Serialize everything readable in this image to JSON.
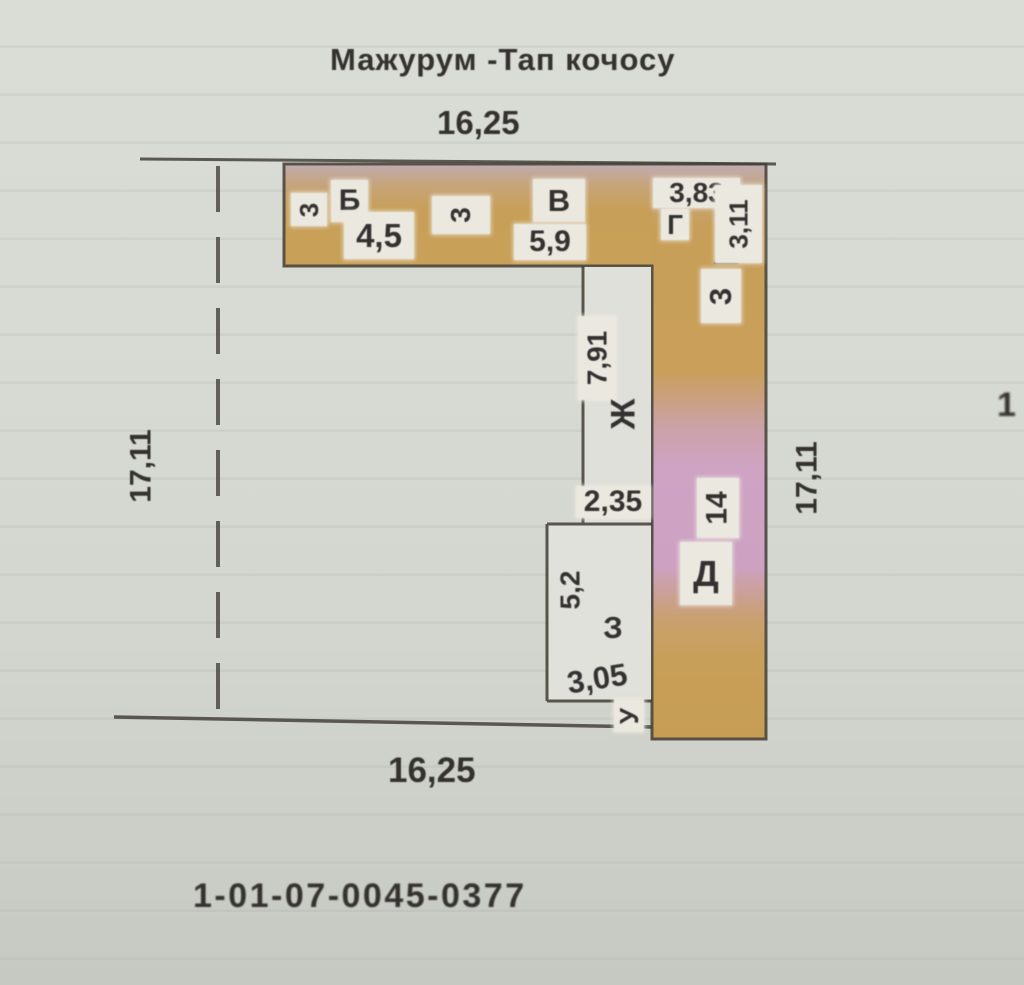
{
  "page": {
    "title": "Мажурум -Тап кочосу",
    "cadastral_number": "1-01-07-0045-0377",
    "edge_artifact": "1"
  },
  "boundary_dimensions": {
    "top": "16,25",
    "bottom": "16,25",
    "left": "17,11",
    "right": "17,11"
  },
  "colors": {
    "paper": "#d7d9d3",
    "band_orange": "#c89f58",
    "band_pink": "#cfa3c4",
    "band_pink_top": "#c0acb1",
    "outline": "#4a463e",
    "ink": "#34322e",
    "label_box": "#ebe8e0"
  },
  "plan": {
    "room_letters": [
      "Б",
      "В",
      "Г",
      "Д",
      "Ж",
      "З",
      "У"
    ],
    "segment_dimensions": [
      "3",
      "4,5",
      "3",
      "5,9",
      "3,83",
      "3,11",
      "3",
      "7,91",
      "2,35",
      "14",
      "5,2",
      "3,05"
    ],
    "labels": [
      {
        "name": "dim-3-a",
        "text": "3",
        "x": 291,
        "y": 193,
        "w": 36,
        "h": 33,
        "rot": -90,
        "fs": 26,
        "box": true
      },
      {
        "name": "room-label-b",
        "text": "Б",
        "x": 331,
        "y": 180,
        "w": 37,
        "h": 42,
        "rot": 0,
        "fs": 30,
        "box": true
      },
      {
        "name": "dim-4-5",
        "text": "4,5",
        "x": 344,
        "y": 212,
        "w": 70,
        "h": 47,
        "rot": 0,
        "fs": 33,
        "box": true
      },
      {
        "name": "dim-3-b",
        "text": "3",
        "x": 432,
        "y": 196,
        "w": 58,
        "h": 38,
        "rot": -90,
        "fs": 28,
        "box": true
      },
      {
        "name": "room-label-v",
        "text": "В",
        "x": 533,
        "y": 179,
        "w": 52,
        "h": 43,
        "rot": 0,
        "fs": 31,
        "box": true
      },
      {
        "name": "dim-5-9",
        "text": "5,9",
        "x": 514,
        "y": 224,
        "w": 72,
        "h": 36,
        "rot": 0,
        "fs": 30,
        "box": true
      },
      {
        "name": "dim-3-83",
        "text": "3,83",
        "x": 653,
        "y": 178,
        "w": 87,
        "h": 30,
        "rot": 0,
        "fs": 28,
        "box": true
      },
      {
        "name": "room-label-g",
        "text": "Г",
        "x": 661,
        "y": 209,
        "w": 28,
        "h": 31,
        "rot": 0,
        "fs": 28,
        "box": true
      },
      {
        "name": "dim-3-11",
        "text": "3,11",
        "x": 715,
        "y": 185,
        "w": 47,
        "h": 78,
        "rot": -90,
        "fs": 26,
        "box": true
      },
      {
        "name": "dim-3-c",
        "text": "3",
        "x": 701,
        "y": 269,
        "w": 40,
        "h": 54,
        "rot": -90,
        "fs": 31,
        "box": true
      },
      {
        "name": "dim-7-91",
        "text": "7,91",
        "x": 578,
        "y": 316,
        "w": 38,
        "h": 84,
        "rot": -90,
        "fs": 28,
        "box": true
      },
      {
        "name": "room-label-zh",
        "text": "Ж",
        "x": 600,
        "y": 390,
        "w": 46,
        "h": 48,
        "rot": -90,
        "fs": 34,
        "box": false
      },
      {
        "name": "dim-2-35",
        "text": "2,35",
        "x": 576,
        "y": 486,
        "w": 74,
        "h": 32,
        "rot": 0,
        "fs": 30,
        "box": true
      },
      {
        "name": "dim-14",
        "text": "14",
        "x": 697,
        "y": 478,
        "w": 42,
        "h": 60,
        "rot": -90,
        "fs": 30,
        "box": true
      },
      {
        "name": "room-label-d",
        "text": "Д",
        "x": 680,
        "y": 542,
        "w": 52,
        "h": 63,
        "rot": 0,
        "fs": 36,
        "box": true
      },
      {
        "name": "dim-5-2",
        "text": "5,2",
        "x": 552,
        "y": 558,
        "w": 36,
        "h": 64,
        "rot": -90,
        "fs": 28,
        "box": false
      },
      {
        "name": "room-label-z",
        "text": "З",
        "x": 597,
        "y": 606,
        "w": 32,
        "h": 42,
        "rot": 0,
        "fs": 31,
        "box": false
      },
      {
        "name": "dim-3-05",
        "text": "3,05",
        "x": 556,
        "y": 660,
        "w": 82,
        "h": 37,
        "rot": -9,
        "fs": 31,
        "box": false
      },
      {
        "name": "room-label-u",
        "text": "У",
        "x": 614,
        "y": 699,
        "w": 30,
        "h": 33,
        "rot": -90,
        "fs": 26,
        "box": true
      }
    ]
  }
}
